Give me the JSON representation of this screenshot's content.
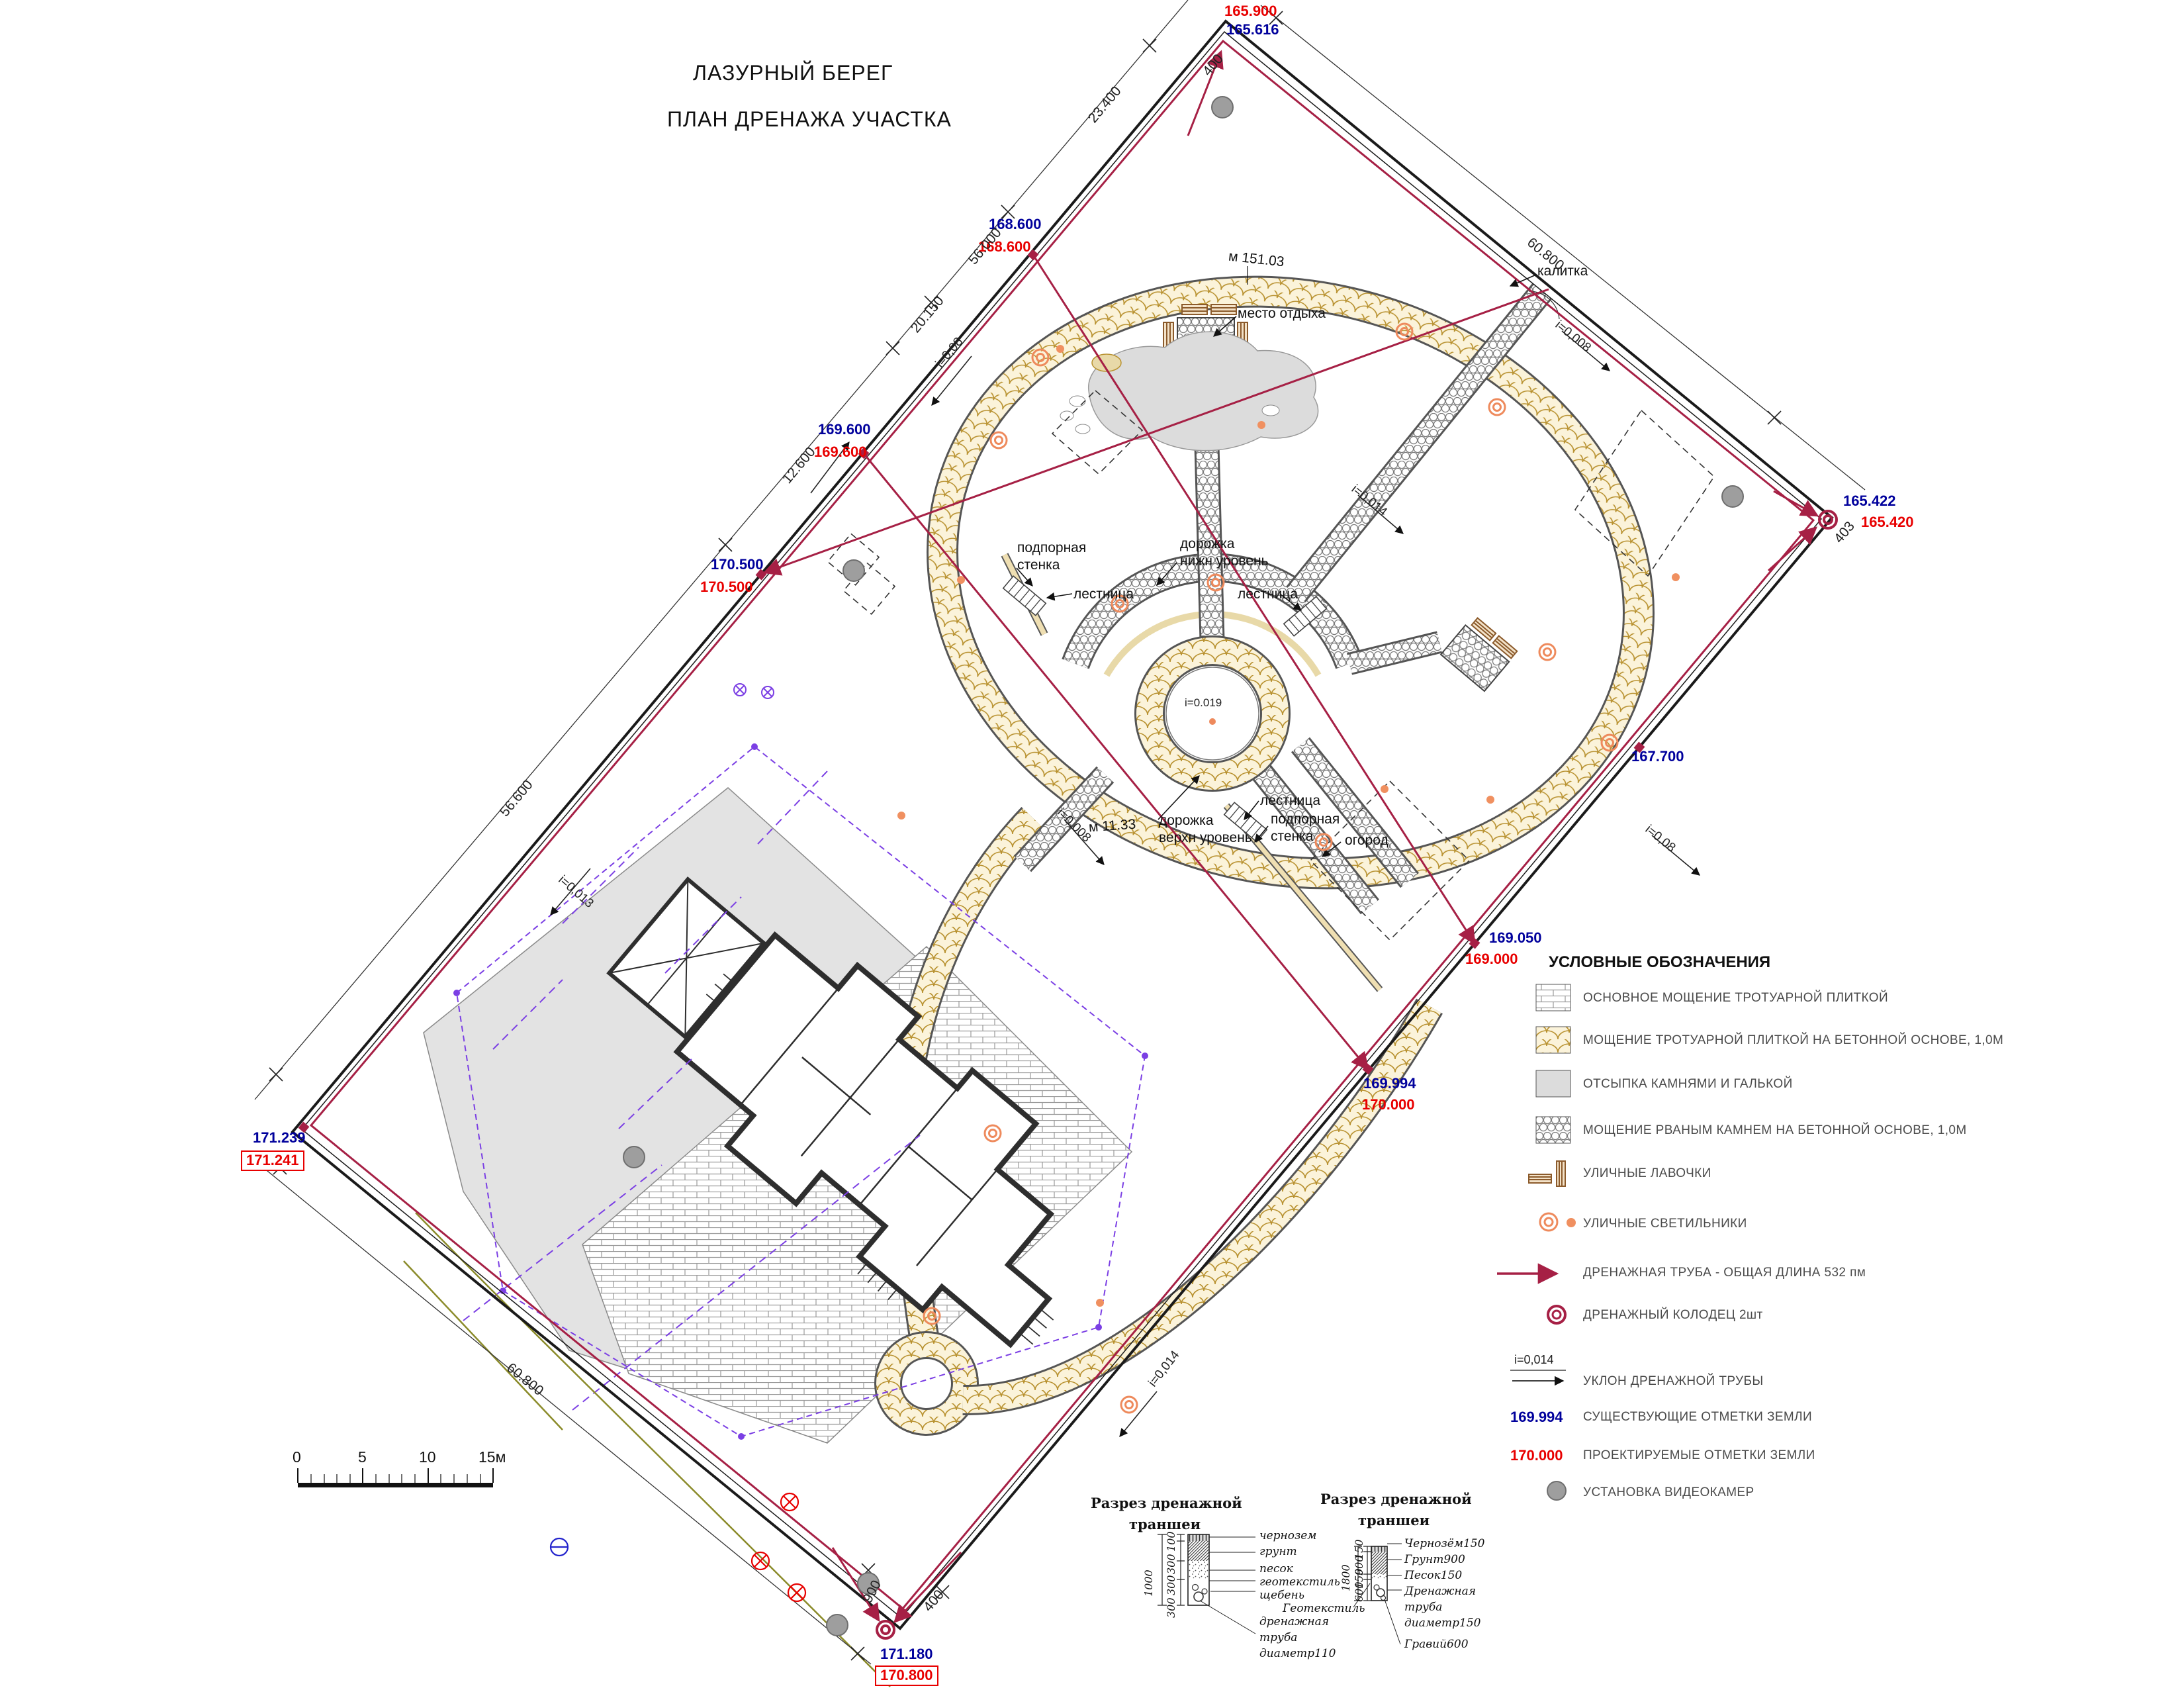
{
  "title": {
    "line1": "ЛАЗУРНЫЙ БЕРЕГ",
    "line2": "ПЛАН ДРЕНАЖА УЧАСТКА"
  },
  "colors": {
    "existing_marks": "#00009C",
    "design_marks": "#E80000",
    "drain_pipe": "#A62045",
    "street_light": "#EE8A5C",
    "stone_tan": "#B8912F",
    "camera_grey": "#9E9E9E",
    "violet": "#7B3FE4",
    "olive": "#8B8B2A"
  },
  "plan": {
    "callouts": {
      "mesto": "место отдыха",
      "kalitka": "калитка",
      "podp1a": "подпорная",
      "podp1b": "стенка",
      "lest1": "лестница",
      "lest2": "лестница",
      "lest3": "лестница",
      "dor1a": "дорожка",
      "dor1b": "нижн уровень",
      "dor2a": "дорожка",
      "dor2b": "верхн уровень",
      "podp2a": "подпорная",
      "podp2b": "стенка",
      "ogorod": "огород",
      "mark1": "м 151.03",
      "mark2": "м 11.33",
      "slope_center": "i=0.019"
    },
    "elevations": {
      "t_red": "165.900",
      "t_blue": "165.616",
      "e1_blue": "168.600",
      "e1_red": "168.600",
      "e2_blue": "169.600",
      "e2_red": "169.600",
      "e3_blue": "170.500",
      "e3_red": "170.500",
      "e4_blue": "171.239",
      "e4_red": "171.241",
      "e5_blue": "165.422",
      "e5_red": "165.420",
      "e6_blue": "167.700",
      "e7_blue": "169.050",
      "e7_red": "169.000",
      "e8_blue": "169.994",
      "e8_red": "170.000",
      "e9_blue": "171.180",
      "e9_red": "170.800"
    },
    "dimensions": {
      "d1": "23.400",
      "d2": "56.000",
      "d3": "20.150",
      "d4": "12.600",
      "d5": "56.600",
      "d6": "60.800",
      "d7": "60.800",
      "d8": "400",
      "d9": "403",
      "d10": "900",
      "d11": "400"
    },
    "slopes": {
      "s1": "i=0,08",
      "s2": "i=0,013",
      "s3": "i=0,008",
      "s4": "i=0,008",
      "s5": "i=0,08",
      "s6": "i=0,014",
      "s7": "i=0,014"
    }
  },
  "legend": {
    "title": "УСЛОВНЫЕ ОБОЗНАЧЕНИЯ",
    "items": [
      {
        "label": "ОСНОВНОЕ МОЩЕНИЕ ТРОТУАРНОЙ ПЛИТКОЙ"
      },
      {
        "label": "МОЩЕНИЕ ТРОТУАРНОЙ ПЛИТКОЙ НА БЕТОННОЙ ОСНОВЕ, 1,0М"
      },
      {
        "label": "ОТСЫПКА КАМНЯМИ И ГАЛЬКОЙ"
      },
      {
        "label": "МОЩЕНИЕ РВАНЫМ КАМНЕМ НА БЕТОННОЙ ОСНОВЕ, 1,0М"
      },
      {
        "label": "УЛИЧНЫЕ ЛАВОЧКИ"
      },
      {
        "label": "УЛИЧНЫЕ СВЕТИЛЬНИКИ"
      },
      {
        "label": "ДРЕНАЖНАЯ ТРУБА  - ОБЩАЯ ДЛИНА  532 пм"
      },
      {
        "label": "ДРЕНАЖНЫЙ КОЛОДЕЦ  2шт"
      },
      {
        "value": "i=0,014",
        "label": "УКЛОН ДРЕНАЖНОЙ ТРУБЫ"
      },
      {
        "value": "169.994",
        "label": "СУЩЕСТВУЮЩИЕ ОТМЕТКИ ЗЕМЛИ"
      },
      {
        "value": "170.000",
        "label": "ПРОЕКТИРУЕМЫЕ ОТМЕТКИ ЗЕМЛИ"
      },
      {
        "label": "УСТАНОВКА ВИДЕОКАМЕР"
      }
    ]
  },
  "sections": {
    "s1": {
      "title1": "Разрез дренажной",
      "title2": "траншеи",
      "dim_total": "1000",
      "dim1": "100",
      "dim2": "300",
      "dim3": "300",
      "dim4": "300",
      "l1": "чернозем",
      "l2": "грунт",
      "l3": "песок",
      "l4": "геотекстиль",
      "l5": "щебень",
      "p1": "дренажная",
      "p2": "труба",
      "p3": "диаметр110"
    },
    "s2": {
      "title1": "Разрез дренажной",
      "title2": "траншеи",
      "dim_total": "1800",
      "dim1": "150",
      "dim2": "900",
      "dim3": "150",
      "dim4": "600",
      "l1": "Чернозём150",
      "l2": "Грунт900",
      "l3": "Песок150",
      "p1": "Дренажная",
      "p2": "труба",
      "p3": "диаметр150",
      "l5": "Гравий600",
      "l6": "Геотекстиль"
    }
  },
  "scalebar": {
    "t0": "0",
    "t5": "5",
    "t10": "10",
    "t15": "15м"
  }
}
